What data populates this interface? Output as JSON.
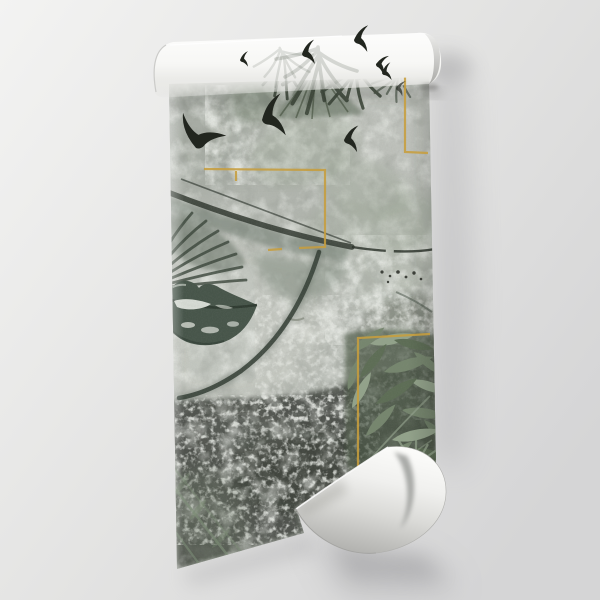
{
  "scene": {
    "subject": "rolled wallpaper product mockup",
    "artwork": "grunge concrete portrait of a woman with green lips and hat, tropical palm leaves, bird silhouettes and gold frames",
    "elements": [
      "roll-cylinder",
      "printed-sheet",
      "page-curl",
      "gold-frames",
      "woman-lips",
      "hat-brim",
      "palm-fronds",
      "bird-silhouettes",
      "leaf-cluster",
      "wall-shadows"
    ]
  },
  "palette": {
    "background_light": "#f3f3f2",
    "background_mid": "#e3e3e2",
    "background_dark": "#d5d5d6",
    "shadow": "#a9a9ac",
    "paper_white": "#fdfdfc",
    "print_base": "#b1b5ae",
    "print_light": "#c7cac3",
    "concrete_white": "#e8ebe5",
    "grunge_dark": "#4b4f48",
    "grunge_deep": "#3b3f39",
    "gold": "#c79e3e",
    "hat_dark": "#2d342c",
    "hat_green": "#5d6c5e",
    "lips_green": "#47554a",
    "lip_light": "#e4e8e1",
    "frond_green": "#3d483a",
    "leaf_light": "#93a38b",
    "leaf_mid": "#76866e",
    "leaf_deep": "#4c5845",
    "bird_dark": "#22261f",
    "curl_white": "#fbfbf9",
    "curl_shade": "#aeaeab"
  }
}
